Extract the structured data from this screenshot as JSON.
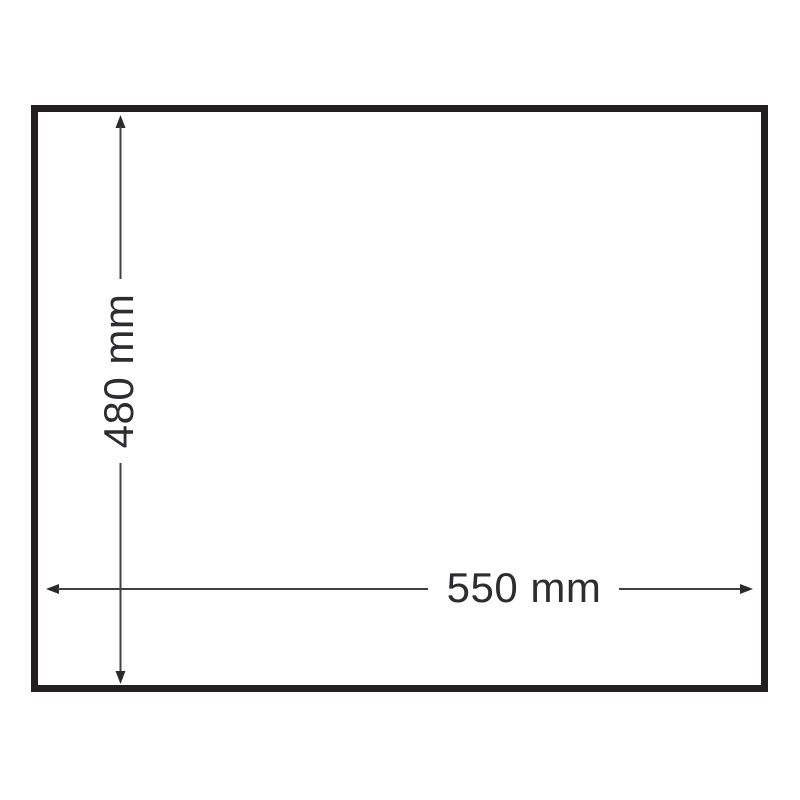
{
  "diagram": {
    "description": "Outline dimension drawing of a rectangular panel",
    "shape": "rectangle",
    "height_dimension": {
      "label": "480 mm",
      "value": 480,
      "unit": "mm",
      "orientation": "vertical"
    },
    "width_dimension": {
      "label": "550 mm",
      "value": 550,
      "unit": "mm",
      "orientation": "horizontal"
    },
    "colors": {
      "background": "#ffffff",
      "outline": "#231f20",
      "dimension_line": "#404040",
      "label_text": "#2d2d31"
    }
  }
}
